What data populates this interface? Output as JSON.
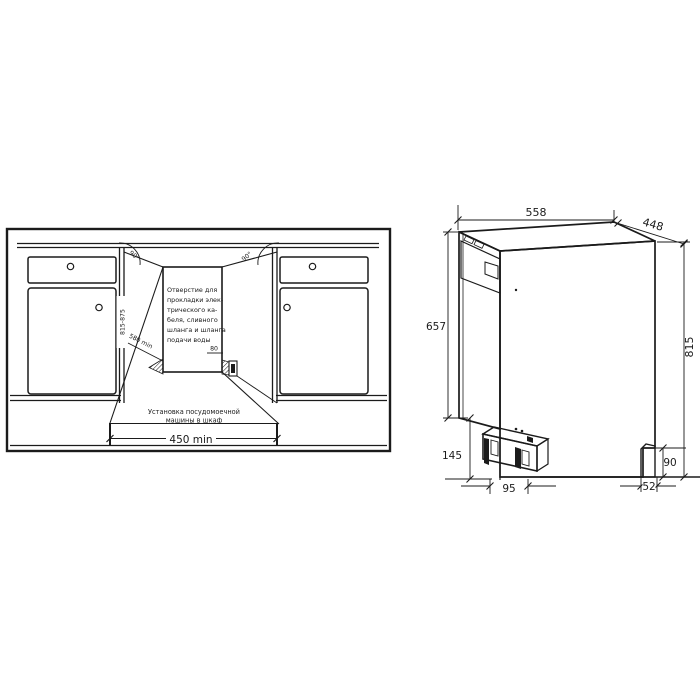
{
  "colors": {
    "background": "#ffffff",
    "line": "#1b1b1b",
    "text": "#1b1b1b"
  },
  "left_diagram": {
    "niche_note_lines": [
      "Отверстие для",
      "прокладки элек-",
      "трического ка-",
      "беля, сливного",
      "шланга и шланга",
      "подачи воды"
    ],
    "caption_lines": [
      "Установка посудомоечной",
      "машины в шкаф"
    ],
    "dims": {
      "cabinet_width_min": "450 min",
      "depth_min": "580 min",
      "niche_height_range": "815-875",
      "hole_size": "80",
      "angle_left": "90°",
      "angle_right": "90°"
    }
  },
  "right_diagram": {
    "dims": {
      "depth": "558",
      "width": "448",
      "door_height": "657",
      "total_height": "815",
      "base_front_height": "145",
      "front_foot_offset": "95",
      "rear_clearance": "90",
      "rear_foot_offset": "52"
    }
  }
}
